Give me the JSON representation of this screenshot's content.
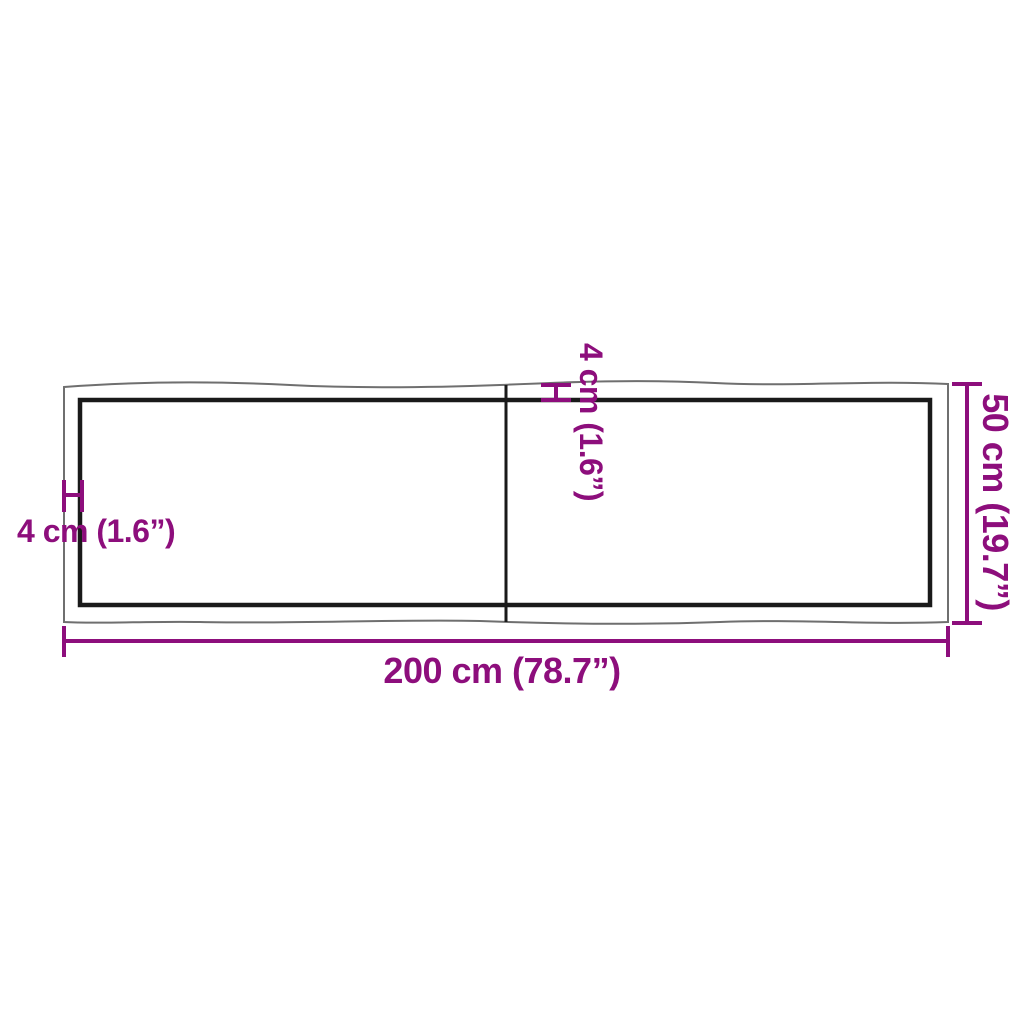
{
  "diagram": {
    "type": "product-dimension-diagram",
    "subject": "table top, top view, two boards with live edge and straight inner edge",
    "colors": {
      "accent": "#8D0E7C",
      "outline": "#6F6F6F",
      "edge": "#1A1A1A",
      "background": "#FFFFFF"
    },
    "labels": {
      "width": "200 cm (78.7”)",
      "depth": "50 cm (19.7”)",
      "edge_left": "4 cm (1.6”)",
      "edge_top": "4 cm (1.6”)"
    }
  }
}
